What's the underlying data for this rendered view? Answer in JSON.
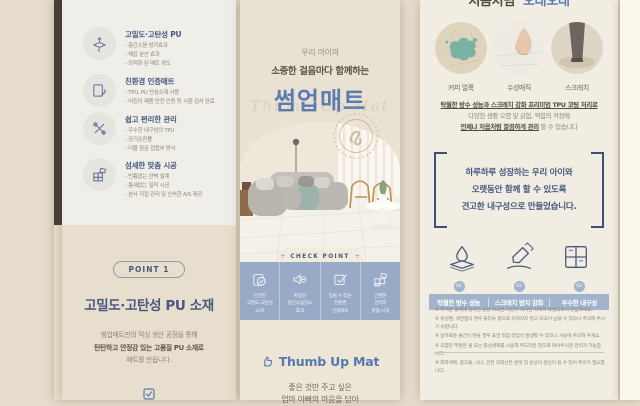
{
  "colors": {
    "navy": "#46597e",
    "blue": "#5b7bb1",
    "band_blue": "#98aac5",
    "beige": "#e5dccb",
    "cream": "#f2ede2"
  },
  "left_panel": {
    "features": [
      {
        "icon": "mat-elastic-icon",
        "title": "고밀도·고탄성 PU",
        "bullets": [
          "- 층간소음 방지효과",
          "- 체압 분산 효과",
          "- 최적화 된 매트 경도"
        ]
      },
      {
        "icon": "eco-cert-icon",
        "title": "친환경 인증매트",
        "bullets": [
          "- TPU, PU 안심소재 사용",
          "- 어린이 제품 안전 인증 등 시험 검사 완료"
        ]
      },
      {
        "icon": "easy-care-icon",
        "title": "쉽고 편리한 관리",
        "bullets": [
          "- 우수한 내구성의 TPU",
          "- 공기순환률",
          "- 더블 잠금 접합부 방식"
        ]
      },
      {
        "icon": "custom-fit-icon",
        "title": "섬세한 맞춤 시공",
        "bullets": [
          "- 빈틈없는 완벽 설계",
          "- 틈새없는 밀착 시공",
          "- 본사 직접 관리 및 신속한 A/S 제공"
        ]
      }
    ],
    "point": {
      "badge": "POINT 1",
      "heading": "고밀도·고탄성 PU 소재",
      "body_line1": "썸업매트만의 믹싱 생산 공정을 통해",
      "body_line2": "탄탄하고 안정감 있는 고품질 PU 소재로",
      "body_line3": "매트를 만듭니다."
    }
  },
  "middle_panel": {
    "eyebrow": "우리 아이의",
    "subtitle": "소중한 걸음마다 함께하는",
    "title": "썸업매트",
    "watermark": "Thumb Up Mat",
    "checkpoint": {
      "label": "CHECK POINT",
      "plus": "+",
      "items": [
        {
          "icon": "mat-check-icon",
          "caption": "안전한\n고밀도·고탄성\n소재"
        },
        {
          "icon": "noise-speaker-icon",
          "caption": "확실한\n층간소음감소\n효과"
        },
        {
          "icon": "certificate-pen-icon",
          "caption": "믿을 수 있는\n친환경\n인증매트"
        },
        {
          "icon": "mat-blocks-icon",
          "caption": "간편한\n관리와\n맞춤 시공"
        }
      ]
    },
    "logo_text": "Thumb Up Mat",
    "footer_line1": "좋은 것만 주고 싶은",
    "footer_line2": "엄마 아빠의 마음을 담아"
  },
  "right_panel": {
    "cut_heading_part1": "처음처럼",
    "cut_heading_part2": "오래오래",
    "circles": [
      {
        "icon": "coffee-stain-photo",
        "caption": "커피 얼룩"
      },
      {
        "icon": "water-marker-photo",
        "caption": "수성매직"
      },
      {
        "icon": "scratch-photo",
        "caption": "스크래치"
      }
    ],
    "para": {
      "line1": "탁월한 방수 성능과 스크래치 강화 프리미엄 TPU 코팅 처리로",
      "line2": "다양한 생활 오염 및 긁힘, 찍힘의 걱정에",
      "line3_strong": "언제나 처음처럼 깔끔하게 관리",
      "line3_rest": " 할 수 있습니다"
    },
    "quote": {
      "line1": "하루하루 성장하는 우리 아이와",
      "line2": "오랫동안 함께 할 수 있도록",
      "line3": "견고한 내구성으로 만들었습니다."
    },
    "points": [
      {
        "num": "01",
        "label": "탁월한 방수 성능",
        "icon": "waterproof-icon"
      },
      {
        "num": "02",
        "label": "스크래치 방지 강화",
        "icon": "anti-scratch-icon"
      },
      {
        "num": "03",
        "label": "우수한 내구성",
        "icon": "durability-icon"
      }
    ],
    "disclaimers": [
      "※ 무거운 물체에 장시간 눌린 자국은 시간이 지나면 서서히 복원되오니 안심하세요.",
      "※ 유성펜, 색연필의 경우 물티슈 등으로 지워지지 않고 자국이 남을 수 있으니 주의해 주시기 바랍니다.",
      "※ 날카로운 물건이 닿을 경우 표면 찍힘·긁힘이 발생할 수 있으니 사용에 주의해 주세요.",
      "※ 오염된 부분은 물 또는 중성세제를 사용해 부드러운 천으로 닦아주시면 관리가 가능합니다.",
      "※ 화학세제, 알코올, 시너, 강한 자외선은 변색 및 손상의 원인이 될 수 있어 주의가 필요합니다."
    ]
  }
}
